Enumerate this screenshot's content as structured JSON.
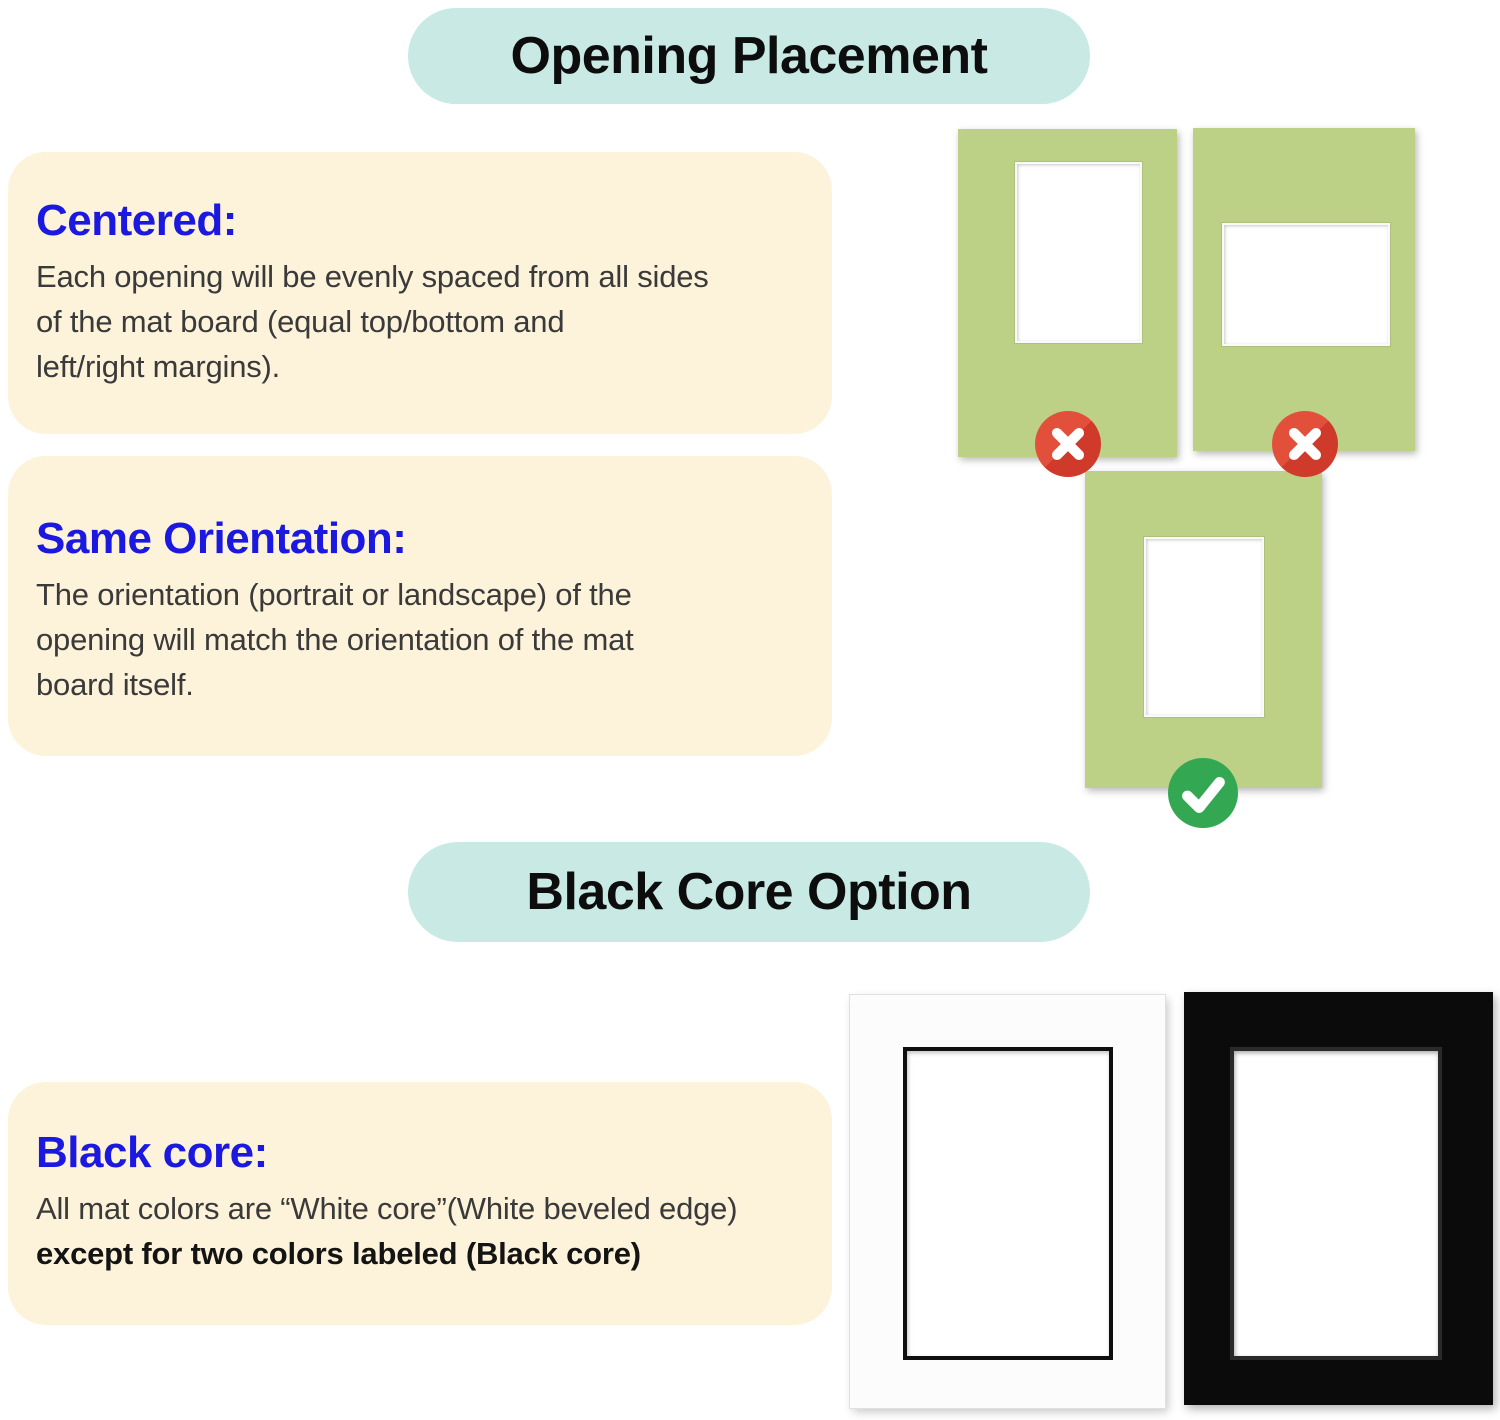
{
  "colors": {
    "banner_teal": "#c9eae4",
    "card_cream": "#fdf2da",
    "heading_blue": "#1b18e0",
    "body_text": "#3a3a3a",
    "banner_text": "#0d0d0d",
    "mat_green": "#bcd086",
    "reject_red": "#e2503c",
    "reject_red_dark": "#cf3a2b",
    "approve_green": "#34a753",
    "mat_black": "#0b0b0b",
    "mat_white": "#fcfcfc"
  },
  "opening_placement": {
    "banner": "Opening Placement",
    "cards": [
      {
        "heading": "Centered:",
        "body": "Each opening will be evenly spaced from all sides\nof the mat board (equal top/bottom and\nleft/right margins)."
      },
      {
        "heading": "Same Orientation:",
        "body": "The orientation (portrait or landscape) of the\nopening will match the orientation of the mat\nboard itself."
      }
    ],
    "examples": [
      {
        "type": "portrait mat with off-center portrait opening",
        "status": "wrong"
      },
      {
        "type": "portrait mat with landscape opening",
        "status": "wrong"
      },
      {
        "type": "portrait mat with centered portrait opening",
        "status": "correct"
      }
    ]
  },
  "black_core": {
    "banner": "Black Core Option",
    "card": {
      "heading": "Black core:",
      "body_regular": "All mat colors are “White core”(White beveled edge)",
      "body_bold": "except for two colors labeled (Black core)"
    },
    "examples": [
      {
        "type": "white mat with black beveled core"
      },
      {
        "type": "black mat with black beveled core"
      }
    ]
  },
  "icons": {
    "reject": "x-circle-icon",
    "approve": "check-circle-icon"
  }
}
